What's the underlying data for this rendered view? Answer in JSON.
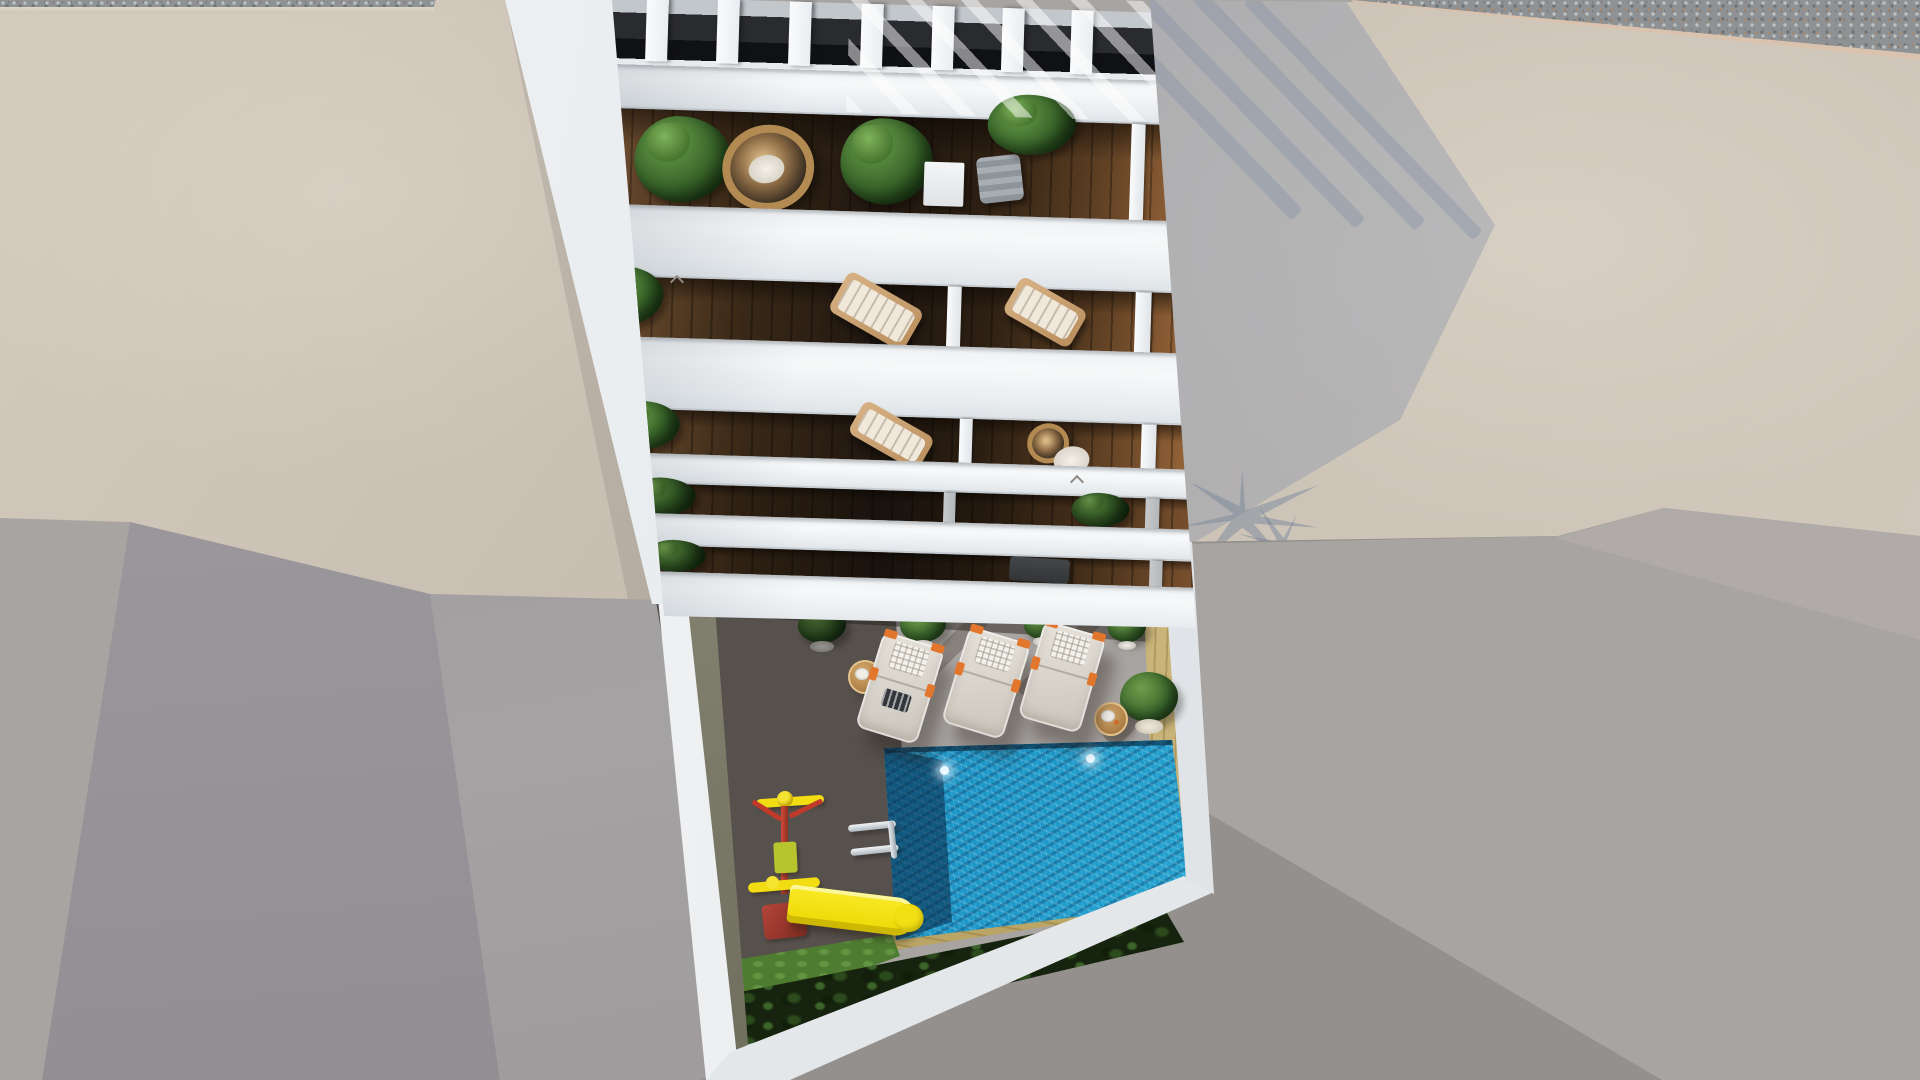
{
  "scene": {
    "title": "Aerial 3D render — white apartment building with pool courtyard",
    "description": "Top-down architectural rendering of a white multi-storey apartment building: slatted pergola roof terrace with wicker egg chair and plants, five balcony levels with dark wood decks, planters and sun chairs, and a ground-floor courtyard with a turquoise swimming pool, three cream sun loungers, two wooden side tables, potted plants, a children's playground with a yellow slide, a dark hedge, tan pool surround, bordered by beige concrete rooftops, a gravel strip and grey ground with long afternoon shadows cast to the lower right.",
    "view": "orthographic aerial, looking straight down the facade",
    "lighting": "sunlight from upper left, hard diagonal shadows"
  },
  "colors": {
    "ground-gray": "#a8a4a1",
    "ground-shadow": "#94908d",
    "roof-beige": "#c8bdb0",
    "gravel-gray": "#8e9294",
    "curb-pink": "#d9c2ae",
    "building-white": "#f4f6f7",
    "slab-shade": "#dfe3e7",
    "deck-lit": "#b0804a",
    "deck-dark": "#3c332c",
    "sand-tan": "#cdb87c",
    "pool-deep": "#0d5a8c",
    "pool-bright": "#33b9df",
    "hedge-green": "#16230e",
    "grass-green": "#4e7c30",
    "plant-green": "#3f6b2f",
    "slide-yellow": "#f2dc12",
    "play-red": "#bf3a2b",
    "play-lime": "#b7c42e",
    "lounger-cream": "#e6e2da",
    "pillow-white": "#f3f1ec",
    "accent-orange": "#e2762d",
    "rattan": "#b28a52",
    "table-wood": "#c79a5f",
    "shadow-blue": "#8c98ae"
  },
  "building": {
    "pergola_slats": 7,
    "balcony_levels": 5,
    "balcony_floor": "dark hardwood planks",
    "roof_terrace_items": [
      "palm plant",
      "rattan egg chair",
      "strelitzia plant",
      "white planter",
      "grey folding chair",
      "corner plants"
    ],
    "balcony_items": [
      "planter shrubs",
      "wooden sun chair with white cushion",
      "rattan round chair",
      "grey lounge chair",
      "white divider posts"
    ],
    "vent_marks": 2
  },
  "courtyard": {
    "pool": {
      "shape": "rectangular",
      "water": "turquoise with ripple sparkle",
      "underwater_lights": 2,
      "ladder": "chrome, two rails"
    },
    "sun_loungers": 3,
    "side_tables": 2,
    "potted_plants": 5,
    "playground": {
      "colors": [
        "yellow",
        "red",
        "lime"
      ],
      "items": [
        "swing frame",
        "climber box",
        "red seat",
        "yellow slide"
      ]
    },
    "hedge": "dark green tropical shrubs along lower wall",
    "lawn_patch": 1,
    "deck": "wood planks, half in building shadow",
    "pool_surround": "light sand-coloured decking strip"
  },
  "surroundings": {
    "top_left": "beige concrete rooftop with gravel edge",
    "top_right": "gravel roof strip, pink curb, beige terrace with building and palm shadows",
    "bottom_left": "faceted grey walls",
    "bottom_right": "grey ground with long building shadow"
  }
}
